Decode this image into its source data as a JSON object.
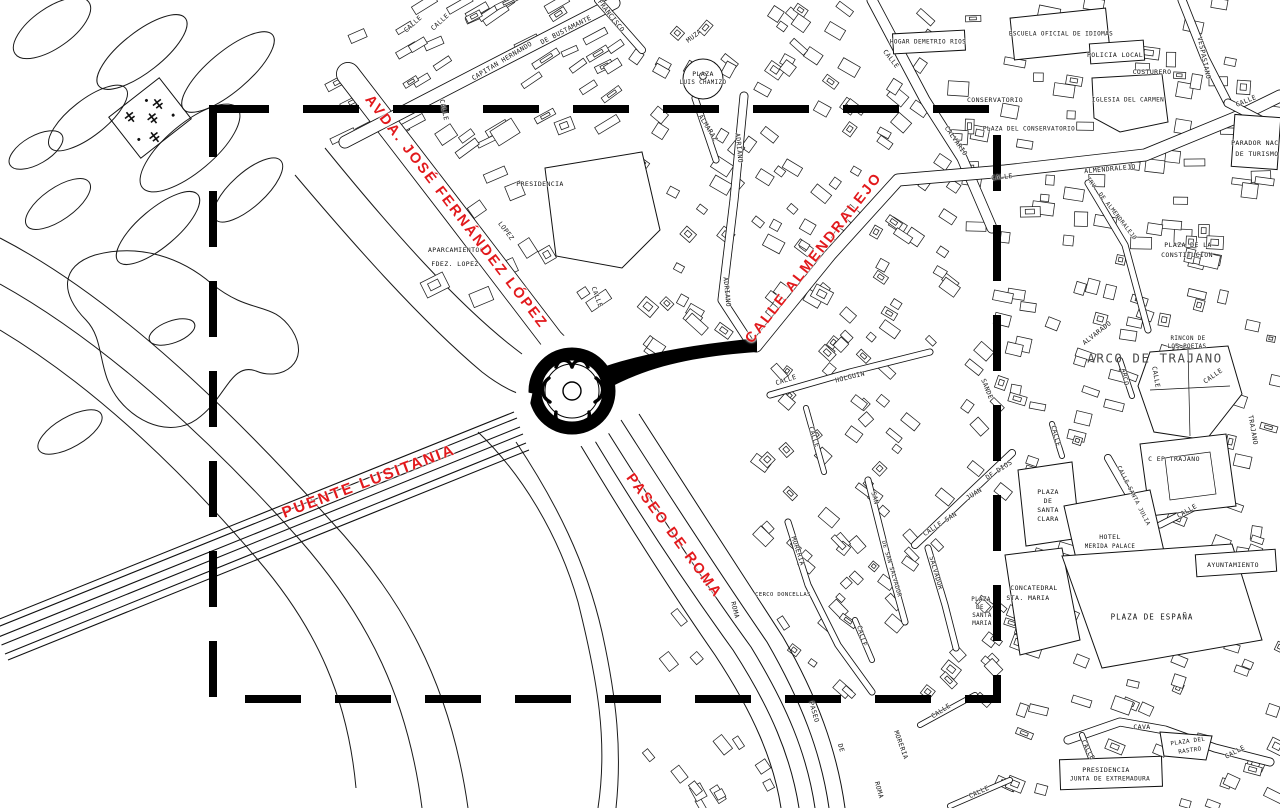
{
  "map": {
    "colors": {
      "highlight": "#e2191c",
      "line": "#000000",
      "background": "#ffffff",
      "muted_label": "#4b4b4b"
    },
    "focus_rect": {
      "x": 213,
      "y": 109,
      "width": 784,
      "height": 590,
      "dash": "56 34",
      "stroke_width": 8
    },
    "red_labels": [
      {
        "t": "AVDA. JOSÉ FERNÁNDEZ LÓPEZ",
        "x": 456,
        "y": 212,
        "r": 52.5,
        "s": 14.5
      },
      {
        "t": "CALLE ALMENDRALEJO",
        "x": 814,
        "y": 258,
        "r": -52,
        "s": 14.5
      },
      {
        "t": "PUENTE LUSITANIA",
        "x": 369,
        "y": 482,
        "r": -20.5,
        "s": 15.5
      },
      {
        "t": "PASEO DE ROMA",
        "x": 674,
        "y": 536,
        "r": 53.5,
        "s": 14.5
      }
    ],
    "black_labels": [
      {
        "t": "CALLE",
        "x": 413,
        "y": 24,
        "r": -42
      },
      {
        "t": "CALLE",
        "x": 440,
        "y": 22,
        "r": -42
      },
      {
        "t": "CAPITAN HERNANDO",
        "x": 502,
        "y": 61,
        "r": -31
      },
      {
        "t": "DE BUSTAMANTE",
        "x": 566,
        "y": 30,
        "r": -27
      },
      {
        "t": "FRANCISCO",
        "x": 611,
        "y": 16,
        "r": 52
      },
      {
        "t": "CALLE",
        "x": 444,
        "y": 110,
        "r": 78
      },
      {
        "t": "PRESIDENCIA",
        "x": 540,
        "y": 184,
        "r": 0
      },
      {
        "t": "APARCAMIENTOS",
        "x": 456,
        "y": 250,
        "r": 0
      },
      {
        "t": "FDEZ. LOPEZ",
        "x": 455,
        "y": 264,
        "r": 0
      },
      {
        "t": "LOPEZ",
        "x": 506,
        "y": 231,
        "r": 53
      },
      {
        "t": "CALLE",
        "x": 597,
        "y": 297,
        "r": 70
      },
      {
        "t": "MUZA",
        "x": 694,
        "y": 36,
        "r": -38
      },
      {
        "t": "PLAZA",
        "x": 703,
        "y": 74,
        "r": 0
      },
      {
        "t": "LUIS CHAMIZO",
        "x": 703,
        "y": 83,
        "r": 0,
        "s": 5.8
      },
      {
        "t": "ALMARAZ",
        "x": 708,
        "y": 128,
        "r": 58
      },
      {
        "t": "ADRIANO",
        "x": 739,
        "y": 148,
        "r": 84
      },
      {
        "t": "ADRIANO",
        "x": 727,
        "y": 292,
        "r": 84
      },
      {
        "t": "HOGAR DEMETRIO RIOS",
        "x": 928,
        "y": 42,
        "r": 0,
        "s": 6
      },
      {
        "t": "CALLE",
        "x": 891,
        "y": 59,
        "r": 52
      },
      {
        "t": "CALVARIO",
        "x": 956,
        "y": 141,
        "r": 55
      },
      {
        "t": "CONSERVATORIO",
        "x": 995,
        "y": 100,
        "r": 0
      },
      {
        "t": "PLAZA DEL CONSERVATORIO",
        "x": 1029,
        "y": 129,
        "r": 0,
        "s": 6
      },
      {
        "t": "ESCUELA OFICIAL DE IDIOMAS",
        "x": 1061,
        "y": 34,
        "r": 0,
        "s": 6
      },
      {
        "t": "POLICIA LOCAL",
        "x": 1115,
        "y": 55,
        "r": 0
      },
      {
        "t": "COSTURERO",
        "x": 1152,
        "y": 72,
        "r": 0
      },
      {
        "t": "IGLESIA DEL CARMEN",
        "x": 1128,
        "y": 100,
        "r": 0,
        "s": 6
      },
      {
        "t": "VESPASIANO",
        "x": 1204,
        "y": 58,
        "r": 78
      },
      {
        "t": "CALLE",
        "x": 1246,
        "y": 101,
        "r": -22
      },
      {
        "t": "PARADOR NAC.",
        "x": 1257,
        "y": 143,
        "r": 0
      },
      {
        "t": "DE TURISMO",
        "x": 1257,
        "y": 154,
        "r": 0
      },
      {
        "t": "CALLE",
        "x": 1002,
        "y": 177,
        "r": -6
      },
      {
        "t": "ALMENDRALEJO",
        "x": 1110,
        "y": 169,
        "r": -5
      },
      {
        "t": "TRV. DE ALMENDRALEJO",
        "x": 1111,
        "y": 209,
        "r": 52,
        "s": 5.8
      },
      {
        "t": "PLAZA DE LA",
        "x": 1188,
        "y": 245,
        "r": 0
      },
      {
        "t": "CONSTITUCION",
        "x": 1187,
        "y": 255,
        "r": 0
      },
      {
        "t": "ALVARADO",
        "x": 1097,
        "y": 333,
        "r": -38
      },
      {
        "t": "RINCON DE",
        "x": 1188,
        "y": 339,
        "r": 0,
        "s": 5.8
      },
      {
        "t": "LOS POETAS",
        "x": 1187,
        "y": 347,
        "r": 0,
        "s": 5.8
      },
      {
        "t": "ARCO DE TRAJANO",
        "x": 1155,
        "y": 358,
        "r": 0,
        "s": 12.5,
        "cls": "big"
      },
      {
        "t": "ARCO",
        "x": 1125,
        "y": 377,
        "r": 80
      },
      {
        "t": "CALLE",
        "x": 1156,
        "y": 377,
        "r": 80
      },
      {
        "t": "CALLE",
        "x": 1213,
        "y": 376,
        "r": -35
      },
      {
        "t": "TRAJANO",
        "x": 1253,
        "y": 430,
        "r": 80
      },
      {
        "t": "CALLE",
        "x": 786,
        "y": 380,
        "r": -18
      },
      {
        "t": "HOLGUIN",
        "x": 850,
        "y": 377,
        "r": -14
      },
      {
        "t": "CALLE",
        "x": 814,
        "y": 437,
        "r": 72
      },
      {
        "t": "MORERIA",
        "x": 798,
        "y": 551,
        "r": 72
      },
      {
        "t": "SAN",
        "x": 875,
        "y": 498,
        "r": 74
      },
      {
        "t": "DE SAN SALVADOR",
        "x": 891,
        "y": 569,
        "r": 74,
        "s": 5.8
      },
      {
        "t": "CALLE SAN",
        "x": 940,
        "y": 524,
        "r": -33
      },
      {
        "t": "JUAN",
        "x": 974,
        "y": 494,
        "r": -33
      },
      {
        "t": "DE DIOS",
        "x": 999,
        "y": 470,
        "r": -33
      },
      {
        "t": "SALVADOR",
        "x": 936,
        "y": 573,
        "r": 74
      },
      {
        "t": "SANDE",
        "x": 987,
        "y": 389,
        "r": 68
      },
      {
        "t": "CERCO DONCELLAS",
        "x": 783,
        "y": 595,
        "r": 0,
        "s": 5.5
      },
      {
        "t": "ROMA",
        "x": 735,
        "y": 610,
        "r": 76
      },
      {
        "t": "CALLE",
        "x": 862,
        "y": 636,
        "r": 74
      },
      {
        "t": "PASEO",
        "x": 814,
        "y": 712,
        "r": 74
      },
      {
        "t": "DE",
        "x": 841,
        "y": 748,
        "r": 74
      },
      {
        "t": "ROMA",
        "x": 879,
        "y": 790,
        "r": 74
      },
      {
        "t": "MORERIA",
        "x": 901,
        "y": 745,
        "r": 70
      },
      {
        "t": "CALLE",
        "x": 941,
        "y": 711,
        "r": -33
      },
      {
        "t": "CALLE",
        "x": 979,
        "y": 792,
        "r": -25
      },
      {
        "t": "PLAZA",
        "x": 981,
        "y": 600,
        "r": 0,
        "s": 5.8
      },
      {
        "t": "DE",
        "x": 980,
        "y": 608,
        "r": 0,
        "s": 5.8
      },
      {
        "t": "SANTA",
        "x": 982,
        "y": 616,
        "r": 0,
        "s": 5.8
      },
      {
        "t": "MARIA",
        "x": 982,
        "y": 624,
        "r": 0,
        "s": 5.8
      },
      {
        "t": "PLAZA",
        "x": 1048,
        "y": 492,
        "r": 0
      },
      {
        "t": "DE",
        "x": 1048,
        "y": 501,
        "r": 0
      },
      {
        "t": "SANTA",
        "x": 1048,
        "y": 510,
        "r": 0
      },
      {
        "t": "CLARA",
        "x": 1048,
        "y": 519,
        "r": 0
      },
      {
        "t": "C EP TRAJANO",
        "x": 1174,
        "y": 459,
        "r": 0
      },
      {
        "t": "CALLE SANTA JULIA",
        "x": 1133,
        "y": 496,
        "r": 63,
        "s": 5.8
      },
      {
        "t": "CALLE",
        "x": 1187,
        "y": 511,
        "r": -30
      },
      {
        "t": "HOTEL",
        "x": 1110,
        "y": 537,
        "r": 0
      },
      {
        "t": "MERIDA PALACE",
        "x": 1110,
        "y": 547,
        "r": 0,
        "s": 5.8
      },
      {
        "t": "AYUNTAMIENTO",
        "x": 1233,
        "y": 565,
        "r": 0
      },
      {
        "t": "CONCATEDRAL",
        "x": 1034,
        "y": 588,
        "r": 0
      },
      {
        "t": "STA. MARIA",
        "x": 1028,
        "y": 598,
        "r": 0
      },
      {
        "t": "PLAZA DE ESPAÑA",
        "x": 1152,
        "y": 617,
        "r": 0,
        "s": 7.5,
        "ls": 1
      },
      {
        "t": "CALLE",
        "x": 1056,
        "y": 436,
        "r": 75
      },
      {
        "t": "CAVA",
        "x": 1142,
        "y": 727,
        "r": 0
      },
      {
        "t": "CALLE",
        "x": 1088,
        "y": 750,
        "r": 62
      },
      {
        "t": "PLAZA DEL",
        "x": 1188,
        "y": 742,
        "r": -8,
        "s": 5.8
      },
      {
        "t": "RASTRO",
        "x": 1190,
        "y": 751,
        "r": -8,
        "s": 5.8
      },
      {
        "t": "CALLE",
        "x": 1235,
        "y": 752,
        "r": -28
      },
      {
        "t": "PRESIDENCIA",
        "x": 1106,
        "y": 770,
        "r": 0
      },
      {
        "t": "JUNTA DE EXTREMADURA",
        "x": 1110,
        "y": 779,
        "r": 0,
        "s": 6
      }
    ]
  }
}
